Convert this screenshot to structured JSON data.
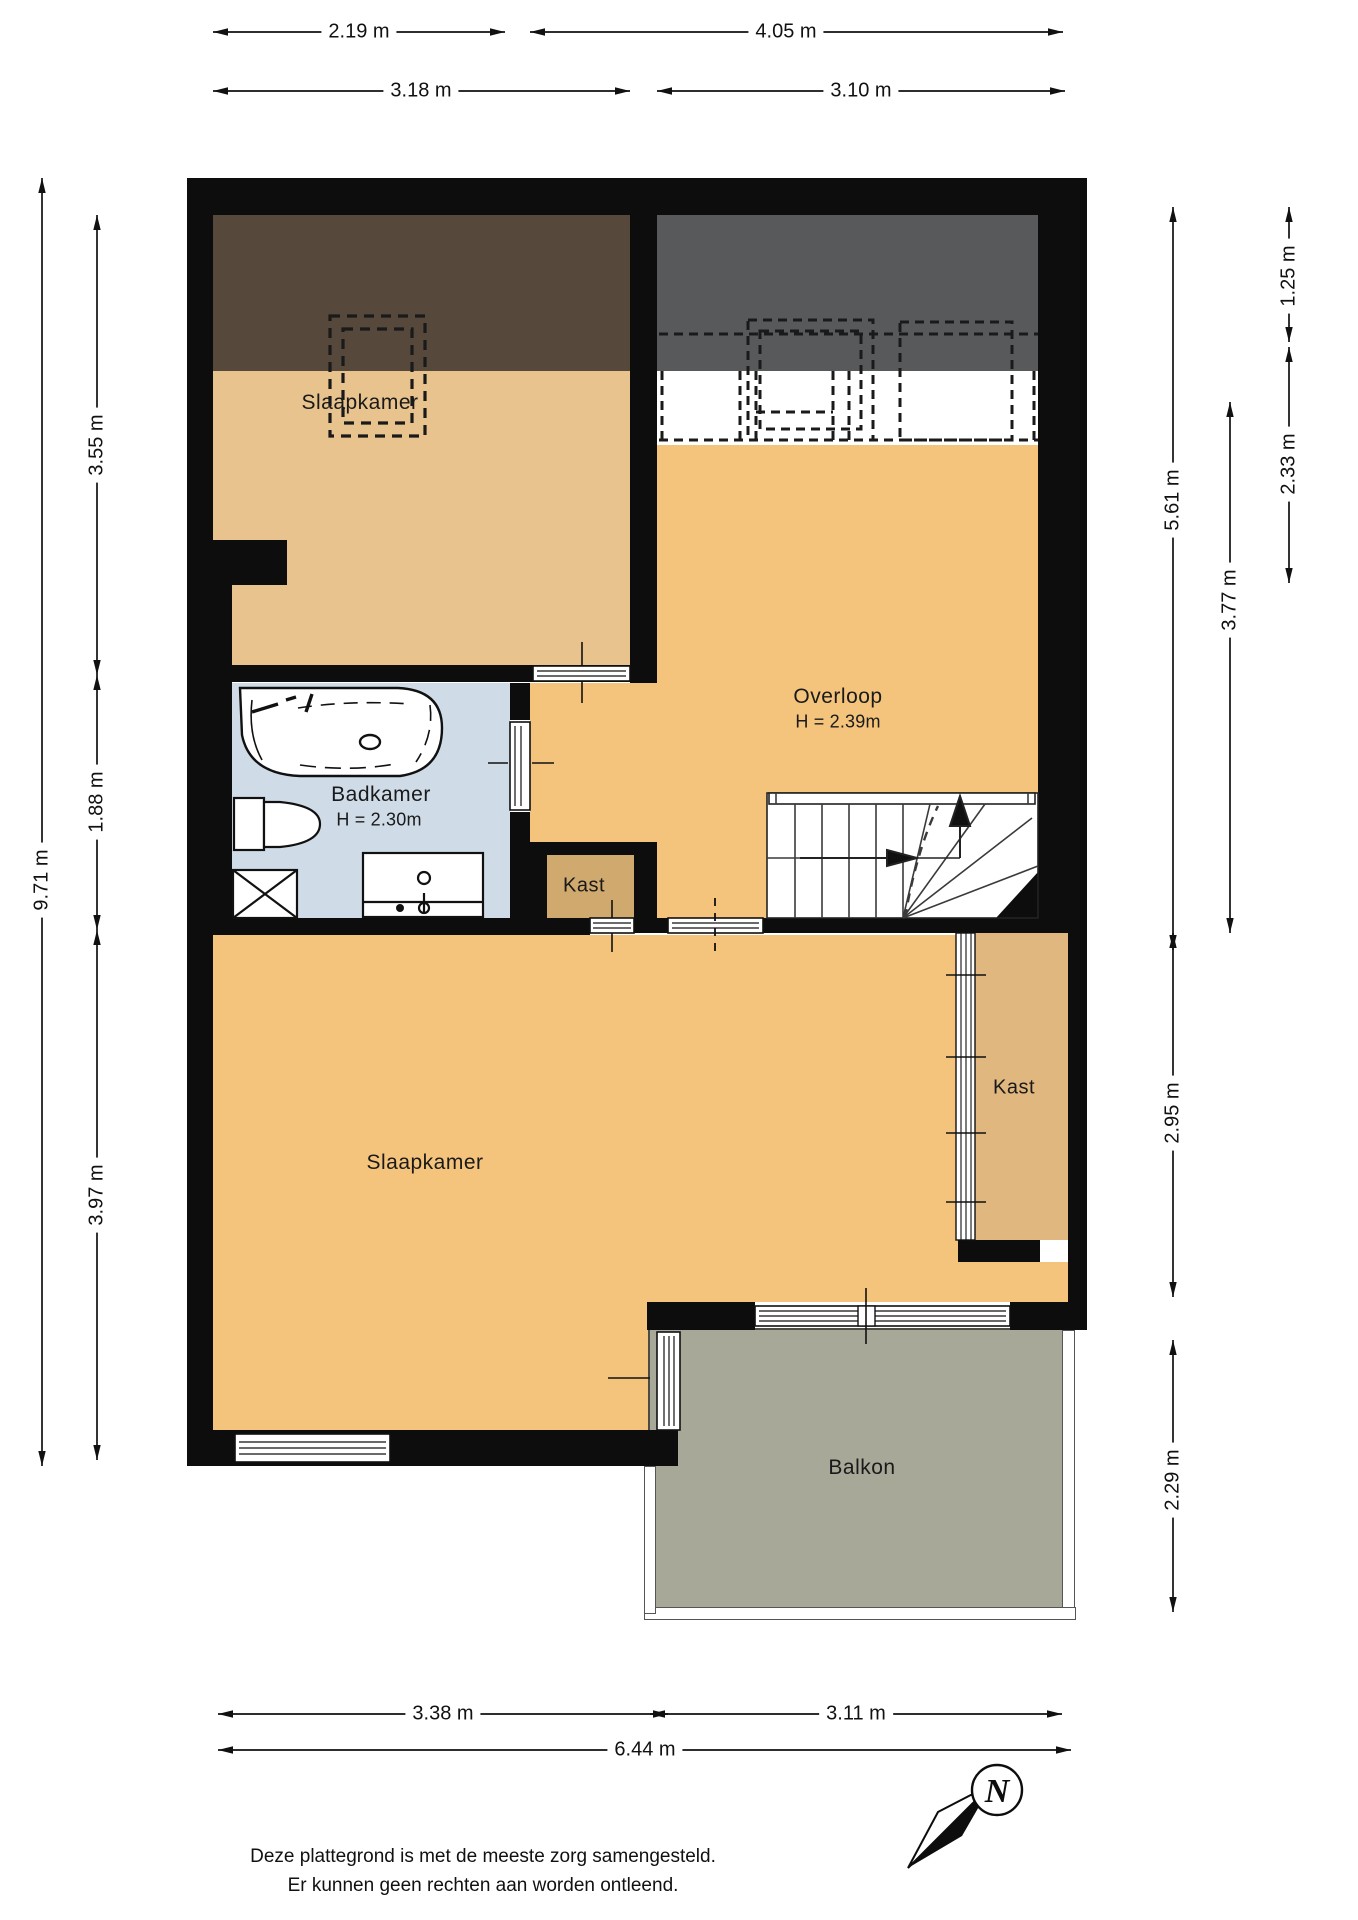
{
  "rooms": {
    "slaapkamer_top": "Slaapkamer",
    "slaapkamer_bottom": "Slaapkamer",
    "overloop": "Overloop",
    "overloop_height": "H = 2.39m",
    "badkamer": "Badkamer",
    "badkamer_height": "H = 2.30m",
    "kast_middle": "Kast",
    "kast_right": "Kast",
    "balkon": "Balkon"
  },
  "dims": {
    "w1": "2.19 m",
    "w2": "4.05 m",
    "w3": "3.18 m",
    "w4": "3.10 m",
    "b1": "3.38 m",
    "b2": "3.11 m",
    "b3": "6.44 m",
    "l1": "9.71 m",
    "l2": "3.55 m",
    "l3": "1.88 m",
    "l4": "3.97 m",
    "r1": "1.25 m",
    "r2": "2.33 m",
    "r3": "5.61 m",
    "r4": "3.77 m",
    "r5": "2.95 m",
    "r6": "2.29 m"
  },
  "compass": {
    "north_label": "N"
  },
  "footer": {
    "line1": "Deze plattegrond is met de meeste zorg samengesteld.",
    "line2": "Er kunnen geen rechten aan worden ontleend."
  },
  "colors": {
    "wall": "#0d0d0d",
    "floor_beige": "#f4c47d",
    "floor_beige_muted": "#e8c38d",
    "roof_low_brown": "#56483a",
    "roof_low_gray": "#58595a",
    "bathroom_blue": "#cfdce8",
    "closet_tan": "#cfa96e",
    "closet_tan_right": "#e0b77e",
    "balcony_gray": "#a7a898"
  }
}
